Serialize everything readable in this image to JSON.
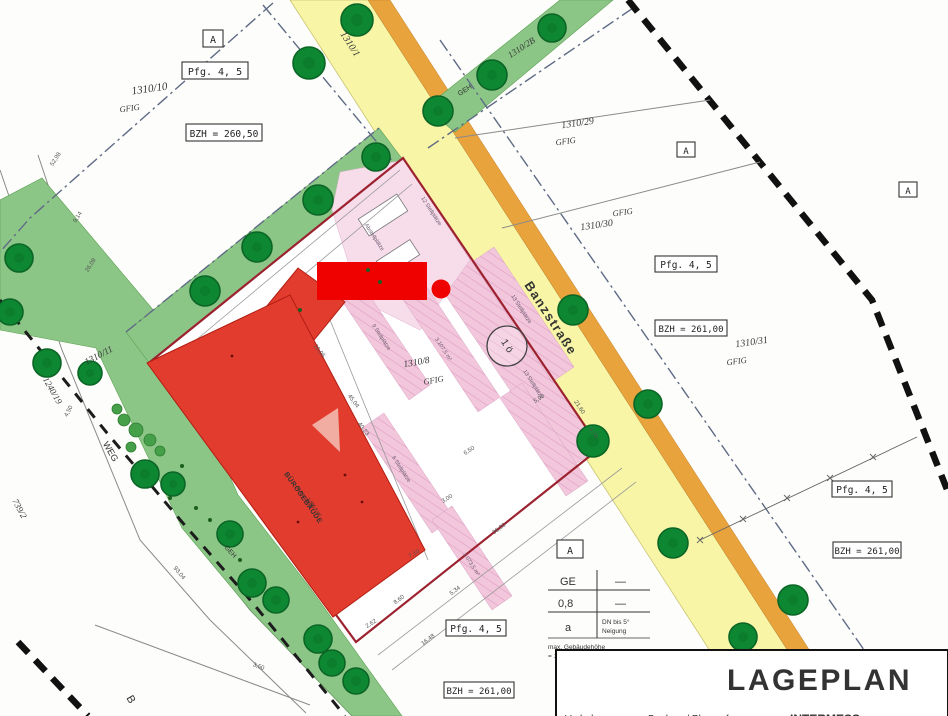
{
  "title_block": {
    "title": "LAGEPLAN",
    "col1": "Vorhaben",
    "col2": "Bauherr / Planverfasser",
    "col3": "INTERMESS"
  },
  "legend": {
    "marker": "A",
    "ge": "GE",
    "dash1": "—",
    "zahl": "0,8",
    "dash2": "—",
    "a": "a",
    "dn1": "DN bis 5°",
    "dn2": "Neigung",
    "note1": "max. Gebäudehöhe",
    "note2": "= 15,00m ab BZH"
  },
  "boxes": {
    "a1": "A",
    "pfg1": "Pfg. 4, 5",
    "bzh1": "BZH = 260,50",
    "a2": "A",
    "pfg2": "Pfg. 4, 5",
    "bzh2": "BZH = 261,00",
    "a3": "A",
    "pfg3": "Pfg. 4, 5",
    "bzh3": "BZH = 261,00",
    "pfg4": "Pfg. 4, 5",
    "bzh4": "BZH = 261,00"
  },
  "parcels": {
    "p1310_1": "1310/1",
    "p1310_2b": "1310/2B",
    "p1310_10": "1310/10",
    "p1310_11": "1310/11",
    "p1310_29": "1310/29",
    "p1310_30": "1310/30",
    "p1310_31": "1310/31",
    "p1310_8": "1310/8",
    "p1240_19": "1240/19",
    "p739_2": "739/2",
    "gfig": "GFIG"
  },
  "streets": {
    "banzstrasse": "Banzstraße",
    "weg": "WEG",
    "geh": "GEH",
    "b": "B"
  },
  "building": {
    "name": "BÜROGEBÄUDE",
    "sub1": "68,94 / 26,20",
    "sub2": "1.805,8 m²"
  },
  "parking": {
    "s9": "9 Stellplätze",
    "s13": "13 Stellplätze",
    "s6": "6 Stellplätze",
    "s12": "12 Stellplätze",
    "area1": "3.107,5 m²",
    "area2": "1.073,5 m²",
    "abst": "Abstellplätze"
  },
  "marker": {
    "one_o": "1 ö"
  },
  "dims": [
    "52,98",
    "9,14",
    "26,09",
    "4,50",
    "93,04",
    "3,50",
    "8,60",
    "16,48",
    "5,34",
    "36,00",
    "45,04",
    "40,23",
    "3,00",
    "7,10",
    "6,50",
    "5,90",
    "2,62",
    "20,95",
    "21,60",
    "9,70"
  ]
}
